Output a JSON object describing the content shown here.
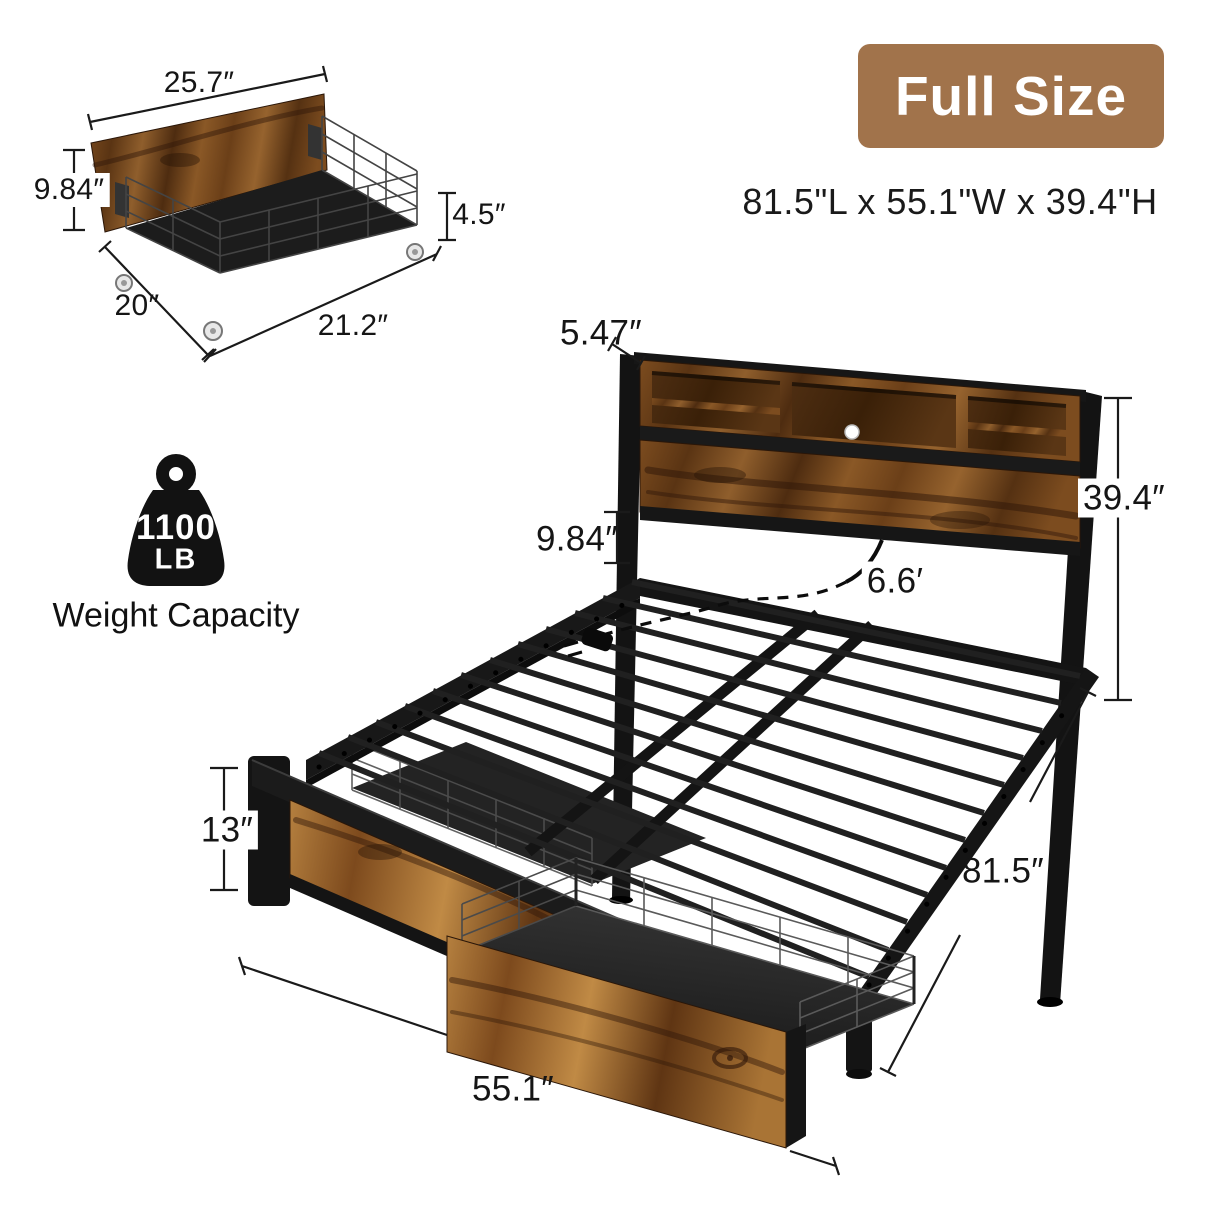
{
  "badge": {
    "label": "Full Size"
  },
  "overall_dimensions": "81.5\"L x 55.1\"W x 39.4\"H",
  "weight_capacity": {
    "value": "1100",
    "unit": "LB",
    "caption": "Weight Capacity"
  },
  "colors": {
    "accent_brown": "#A1734B",
    "wood_mid": "#8a5a28",
    "wood_dark": "#4e2c10",
    "metal_black": "#161616",
    "label_text": "#151515"
  },
  "drawer_diagram": {
    "dims": {
      "top_width": "25.7″",
      "front_height": "9.84″",
      "side_height": "4.5″",
      "depth": "20″",
      "bottom_width": "21.2″"
    }
  },
  "bed_diagram": {
    "dims": {
      "headboard_top_depth": "5.47″",
      "under_headboard_clearance": "9.84″",
      "cord_length": "6.6′",
      "headboard_height": "39.4″",
      "footboard_height": "13″",
      "bed_length": "81.5″",
      "bed_width": "55.1″"
    }
  }
}
